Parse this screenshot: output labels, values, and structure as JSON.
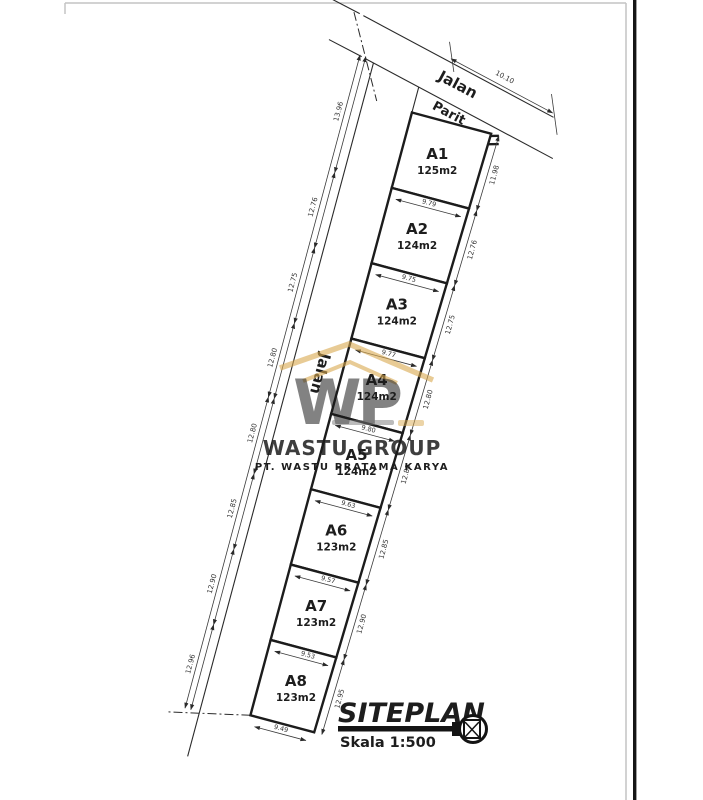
{
  "colors": {
    "line": "#1c1c1c",
    "dim": "#3a3a3a",
    "gold": "#c89243",
    "gold_light": "#e3bf7d",
    "gray_text": "#9a9a9a",
    "frame": "#c4c4c4",
    "edge_bar": "#151515"
  },
  "roads": {
    "top_label": "Jalan",
    "left_label": "Jalan",
    "ditch_label": "Parit",
    "top_width_dim": "10.10"
  },
  "plots": [
    {
      "id": "A1",
      "area": "125m2"
    },
    {
      "id": "A2",
      "area": "124m2"
    },
    {
      "id": "A3",
      "area": "124m2"
    },
    {
      "id": "A4",
      "area": "124m2"
    },
    {
      "id": "A5",
      "area": "124m2"
    },
    {
      "id": "A6",
      "area": "123m2"
    },
    {
      "id": "A7",
      "area": "123m2"
    },
    {
      "id": "A8",
      "area": "123m2"
    }
  ],
  "dims": {
    "cross": [
      "9.79",
      "9.75",
      "9.77",
      "9.80",
      "9.63",
      "9.57",
      "9.53",
      "9.49"
    ],
    "right": [
      "11.98",
      "12.76",
      "12.75",
      "12.80",
      "12.80",
      "12.85",
      "12.90",
      "12.95"
    ],
    "left": [
      "13.96",
      "12.76",
      "12.75",
      "12.80",
      "12.80",
      "12.85",
      "12.90",
      "12.96"
    ]
  },
  "watermark": {
    "monogram": "WP",
    "name": "WASTU GROUP",
    "subtitle": "PT. WASTU PRATAMA KARYA"
  },
  "title_block": {
    "title": "SITEPLAN",
    "scale": "Skala 1:500"
  }
}
